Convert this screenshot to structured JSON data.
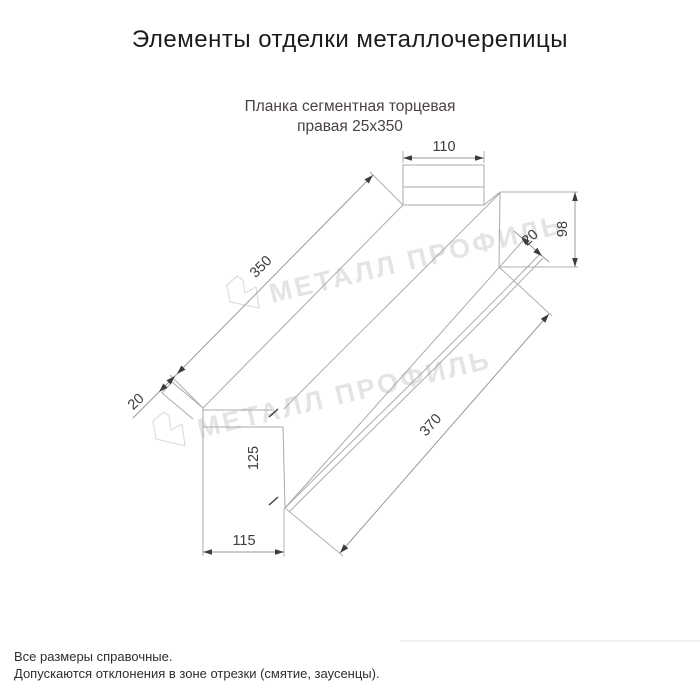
{
  "title": "Элементы отделки металлочерепицы",
  "subtitle": {
    "line1": "Планка сегментная торцевая",
    "line2": "правая 25x350"
  },
  "product": {
    "name": "Планка сегментная торцевая правая",
    "size": "25x350"
  },
  "dimensions": {
    "top_width": "110",
    "strip_length": "350",
    "right_height": "98",
    "right_fold": "20",
    "left_fold": "20",
    "face_height": "125",
    "bottom_width": "115",
    "bottom_length": "370"
  },
  "watermark": {
    "text": "МЕТАЛЛ ПРОФИЛЬ",
    "logo": "sail-pentagon-icon",
    "color": "#e4e4e4"
  },
  "footer": {
    "line1": "Все размеры справочные.",
    "line2": "Допускаются отклонения в зоне отрезки (смятие, заусенцы)."
  },
  "colors": {
    "background": "#ffffff",
    "title_text": "#1c1c1c",
    "subtitle_text": "#4a4242",
    "drawing_line": "#ababab",
    "dimension_text": "#3d3d3d"
  }
}
